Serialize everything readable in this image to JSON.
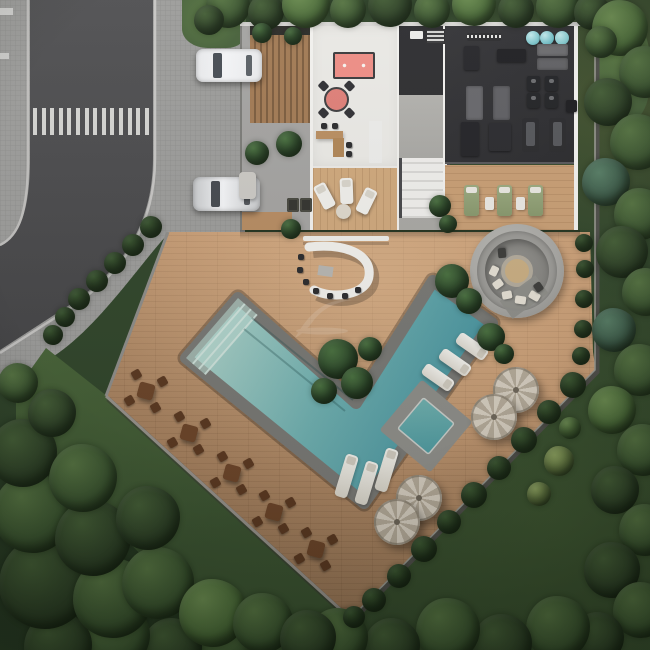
{
  "scene": {
    "kind": "aerial-site-plan-render",
    "view": "top-down",
    "areas": [
      "street",
      "sidewalk",
      "parking-bay",
      "clubhouse",
      "games-room",
      "gym",
      "pergola-deck",
      "bar-counter",
      "fire-pit-lounge",
      "swimming-pool",
      "spa",
      "pool-deck",
      "dining-terrace",
      "forest"
    ]
  },
  "palette": {
    "road": "#4b4b4d",
    "sidewalk": "#9c9c9a",
    "crosswalk": "#e0e0dc",
    "deck_wood": "#c69a72",
    "terrace_wood": "#cfa87c",
    "building_floor": "#eae9e5",
    "gym_floor": "#303033",
    "pergola_wood": "#a27a54",
    "pool_shallow": "#a9cfc6",
    "pool_deep": "#3e8d9b",
    "pool_coping": "#787874",
    "billiard_felt": "#ee8d85",
    "card_table": "#df7f78",
    "bar_counter": "#f2f1ed",
    "fire_pit_concrete": "#a8a7a3",
    "umbrella": "#d6cec0",
    "dining_table": "#6b4428",
    "green_lounger": "#93a37b",
    "exercise_ball": "#7ac3c9",
    "tree_dark": "#2d4026",
    "tree_light": "#6b8c50",
    "grass": "#4c6839"
  },
  "street": {
    "crosswalk": {
      "x": 33,
      "y": 108,
      "count": 14,
      "w": 4,
      "h": 27,
      "step": 8.6
    },
    "edge_marks": [
      {
        "x": 0,
        "y": 8,
        "w": 13,
        "h": 7
      },
      {
        "x": 0,
        "y": 53,
        "w": 9,
        "h": 6
      }
    ]
  },
  "tree_palettes": {
    "d": [
      "#2d4026",
      "#445e36"
    ],
    "m": [
      "#3b5530",
      "#567442"
    ],
    "l": [
      "#4a6a38",
      "#6b8c50"
    ],
    "y": [
      "#697f45",
      "#8ba05e"
    ],
    "t": [
      "#3c5a48",
      "#567c64"
    ],
    "s": [
      "#283c22",
      "#3a5630"
    ],
    "p": [
      "#2e4a2b",
      "#49703f"
    ]
  },
  "trees": [
    [
      228,
      6,
      22,
      "m"
    ],
    [
      266,
      12,
      18,
      "d"
    ],
    [
      306,
      4,
      24,
      "l"
    ],
    [
      348,
      10,
      18,
      "m"
    ],
    [
      390,
      5,
      22,
      "d"
    ],
    [
      432,
      10,
      18,
      "m"
    ],
    [
      474,
      4,
      22,
      "l"
    ],
    [
      516,
      10,
      18,
      "d"
    ],
    [
      558,
      6,
      22,
      "m"
    ],
    [
      592,
      12,
      18,
      "d"
    ],
    [
      620,
      28,
      28,
      "l"
    ],
    [
      645,
      72,
      26,
      "m"
    ],
    [
      608,
      102,
      24,
      "d"
    ],
    [
      638,
      142,
      28,
      "m"
    ],
    [
      606,
      182,
      24,
      "t"
    ],
    [
      640,
      214,
      26,
      "m"
    ],
    [
      622,
      252,
      26,
      "d"
    ],
    [
      646,
      292,
      24,
      "m"
    ],
    [
      614,
      330,
      22,
      "t"
    ],
    [
      640,
      370,
      26,
      "m"
    ],
    [
      612,
      410,
      24,
      "l"
    ],
    [
      643,
      450,
      26,
      "m"
    ],
    [
      615,
      490,
      24,
      "d"
    ],
    [
      645,
      530,
      26,
      "m"
    ],
    [
      612,
      570,
      28,
      "d"
    ],
    [
      641,
      610,
      28,
      "m"
    ],
    [
      598,
      638,
      26,
      "d"
    ],
    [
      558,
      628,
      32,
      "m"
    ],
    [
      502,
      644,
      30,
      "d"
    ],
    [
      448,
      630,
      32,
      "m"
    ],
    [
      392,
      646,
      28,
      "d"
    ],
    [
      338,
      638,
      30,
      "m"
    ],
    [
      282,
      648,
      28,
      "d"
    ],
    [
      228,
      638,
      32,
      "m"
    ],
    [
      172,
      648,
      30,
      "d"
    ],
    [
      116,
      636,
      34,
      "m"
    ],
    [
      58,
      646,
      34,
      "d"
    ],
    [
      45,
      583,
      46,
      "d"
    ],
    [
      113,
      598,
      40,
      "m"
    ],
    [
      33,
      513,
      40,
      "m"
    ],
    [
      93,
      538,
      38,
      "d"
    ],
    [
      158,
      583,
      36,
      "m"
    ],
    [
      23,
      453,
      34,
      "d"
    ],
    [
      83,
      478,
      34,
      "m"
    ],
    [
      148,
      518,
      32,
      "d"
    ],
    [
      213,
      613,
      34,
      "l"
    ],
    [
      263,
      623,
      30,
      "m"
    ],
    [
      308,
      638,
      28,
      "d"
    ],
    [
      52,
      413,
      24,
      "d"
    ],
    [
      18,
      383,
      20,
      "m"
    ],
    [
      573,
      385,
      13,
      "s"
    ],
    [
      549,
      412,
      12,
      "s"
    ],
    [
      524,
      440,
      13,
      "s"
    ],
    [
      499,
      468,
      12,
      "s"
    ],
    [
      474,
      495,
      13,
      "s"
    ],
    [
      449,
      522,
      12,
      "s"
    ],
    [
      424,
      549,
      13,
      "s"
    ],
    [
      399,
      576,
      12,
      "s"
    ],
    [
      374,
      600,
      12,
      "s"
    ],
    [
      354,
      617,
      11,
      "s"
    ],
    [
      584,
      243,
      9,
      "s"
    ],
    [
      585,
      269,
      9,
      "s"
    ],
    [
      584,
      299,
      9,
      "s"
    ],
    [
      583,
      329,
      9,
      "s"
    ],
    [
      581,
      356,
      9,
      "s"
    ],
    [
      559,
      461,
      15,
      "y"
    ],
    [
      539,
      494,
      12,
      "y"
    ],
    [
      570,
      428,
      11,
      "l"
    ],
    [
      151,
      227,
      11,
      "s"
    ],
    [
      133,
      245,
      11,
      "s"
    ],
    [
      115,
      263,
      11,
      "s"
    ],
    [
      97,
      281,
      11,
      "s"
    ],
    [
      79,
      299,
      11,
      "s"
    ],
    [
      65,
      317,
      10,
      "s"
    ],
    [
      53,
      335,
      10,
      "s"
    ],
    [
      338,
      359,
      20,
      "p"
    ],
    [
      357,
      383,
      16,
      "p"
    ],
    [
      324,
      391,
      13,
      "p"
    ],
    [
      370,
      349,
      12,
      "p"
    ],
    [
      452,
      281,
      17,
      "p"
    ],
    [
      469,
      301,
      13,
      "p"
    ],
    [
      491,
      337,
      14,
      "p"
    ],
    [
      504,
      354,
      10,
      "p"
    ],
    [
      291,
      229,
      10,
      "p"
    ],
    [
      440,
      206,
      11,
      "p"
    ],
    [
      448,
      224,
      9,
      "p"
    ],
    [
      257,
      153,
      12,
      "p"
    ],
    [
      289,
      144,
      13,
      "p"
    ],
    [
      262,
      33,
      10,
      "p"
    ],
    [
      293,
      36,
      9,
      "p"
    ],
    [
      209,
      20,
      15,
      "d"
    ],
    [
      601,
      42,
      16,
      "m"
    ]
  ],
  "props": [
    {
      "cls": "car",
      "name": "parked-car",
      "x": 196,
      "y": 49,
      "w": 66,
      "h": 33,
      "c": "#e9eaec"
    },
    {
      "cls": "carwin",
      "name": "car-windshield",
      "x": 213,
      "y": 53,
      "w": 9,
      "h": 25,
      "c": "#474d54"
    },
    {
      "cls": "carwin",
      "name": "car-rear-window",
      "x": 246,
      "y": 55,
      "w": 6,
      "h": 21,
      "c": "#5a6066"
    },
    {
      "cls": "car",
      "name": "parked-car",
      "x": 193,
      "y": 177,
      "w": 67,
      "h": 34,
      "c": "#c8cacc"
    },
    {
      "cls": "carwin",
      "name": "car-windshield",
      "x": 211,
      "y": 181,
      "w": 9,
      "h": 26,
      "c": "#45494f"
    },
    {
      "cls": "carwin",
      "name": "car-rear-window",
      "x": 244,
      "y": 184,
      "w": 6,
      "h": 21,
      "c": "#53575c"
    },
    {
      "cls": "ball",
      "name": "exercise-ball",
      "x": 526,
      "y": 31,
      "w": 14,
      "h": 14,
      "c": "#7ac3c9"
    },
    {
      "cls": "ball",
      "name": "exercise-ball",
      "x": 540,
      "y": 31,
      "w": 14,
      "h": 14,
      "c": "#6fbcc4"
    },
    {
      "cls": "ball",
      "name": "exercise-ball",
      "x": 555,
      "y": 31,
      "w": 14,
      "h": 14,
      "c": "#83c8cd"
    },
    {
      "cls": "rackrow",
      "name": "dumbbell-rack",
      "x": 467,
      "y": 33,
      "w": 34,
      "h": 8
    },
    {
      "cls": "vbox",
      "name": "roof-vent",
      "x": 410,
      "y": 31,
      "w": 13,
      "h": 8
    },
    {
      "cls": "grille",
      "name": "roof-grille",
      "x": 426,
      "y": 29,
      "w": 17,
      "h": 13
    },
    {
      "cls": "mat",
      "name": "gym-mat",
      "x": 537,
      "y": 44,
      "w": 31,
      "h": 12,
      "c": "#6b6b6e"
    },
    {
      "cls": "mat",
      "name": "gym-mat",
      "x": 537,
      "y": 58,
      "w": 31,
      "h": 12,
      "c": "#606063"
    },
    {
      "cls": "gear",
      "name": "gym-bench",
      "x": 497,
      "y": 49,
      "w": 29,
      "h": 13,
      "c": "#1f1f22"
    },
    {
      "cls": "gear",
      "name": "weight-station",
      "x": 464,
      "y": 46,
      "w": 15,
      "h": 24,
      "c": "#26262a"
    },
    {
      "cls": "bike",
      "name": "spin-bike",
      "x": 527,
      "y": 76,
      "w": 13,
      "h": 15
    },
    {
      "cls": "bike",
      "name": "spin-bike",
      "x": 545,
      "y": 76,
      "w": 13,
      "h": 15
    },
    {
      "cls": "bike",
      "name": "spin-bike",
      "x": 527,
      "y": 93,
      "w": 13,
      "h": 15
    },
    {
      "cls": "bike",
      "name": "spin-bike",
      "x": 545,
      "y": 93,
      "w": 13,
      "h": 15
    },
    {
      "cls": "mat",
      "name": "stretch-mat",
      "x": 466,
      "y": 86,
      "w": 17,
      "h": 34,
      "c": "#67676b"
    },
    {
      "cls": "mat",
      "name": "stretch-mat",
      "x": 493,
      "y": 86,
      "w": 17,
      "h": 34,
      "c": "#5f5f63"
    },
    {
      "cls": "tread",
      "name": "treadmill",
      "x": 522,
      "y": 118,
      "w": 17,
      "h": 34
    },
    {
      "cls": "tread",
      "name": "treadmill",
      "x": 549,
      "y": 118,
      "w": 17,
      "h": 34
    },
    {
      "cls": "gear",
      "name": "gym-machine",
      "x": 461,
      "y": 122,
      "w": 18,
      "h": 34,
      "c": "#232327"
    },
    {
      "cls": "gear",
      "name": "multi-gym",
      "x": 489,
      "y": 123,
      "w": 22,
      "h": 28,
      "c": "#2a2a2e"
    },
    {
      "cls": "gear",
      "name": "gym-door",
      "x": 566,
      "y": 100,
      "w": 11,
      "h": 12,
      "c": "#1c1c1f"
    },
    {
      "cls": "stool",
      "name": "bar-stool",
      "x": 298,
      "y": 254,
      "w": 6,
      "h": 6
    },
    {
      "cls": "stool",
      "name": "bar-stool",
      "x": 297,
      "y": 267,
      "w": 6,
      "h": 6
    },
    {
      "cls": "stool",
      "name": "bar-stool",
      "x": 303,
      "y": 279,
      "w": 6,
      "h": 6
    },
    {
      "cls": "stool",
      "name": "bar-stool",
      "x": 313,
      "y": 288,
      "w": 6,
      "h": 6
    },
    {
      "cls": "stool",
      "name": "bar-stool",
      "x": 327,
      "y": 293,
      "w": 6,
      "h": 6
    },
    {
      "cls": "stool",
      "name": "bar-stool",
      "x": 342,
      "y": 293,
      "w": 6,
      "h": 6
    },
    {
      "cls": "stool",
      "name": "bar-stool",
      "x": 355,
      "y": 287,
      "w": 6,
      "h": 6
    },
    {
      "cls": "stool",
      "name": "bar-stool",
      "x": 321,
      "y": 123,
      "w": 6,
      "h": 6
    },
    {
      "cls": "stool",
      "name": "bar-stool",
      "x": 332,
      "y": 123,
      "w": 6,
      "h": 6
    },
    {
      "cls": "stool",
      "name": "bar-stool",
      "x": 346,
      "y": 142,
      "w": 6,
      "h": 6
    },
    {
      "cls": "stool",
      "name": "bar-stool",
      "x": 346,
      "y": 151,
      "w": 6,
      "h": 6
    },
    {
      "cls": "vbox",
      "name": "kitchen-counter",
      "x": 369,
      "y": 121,
      "w": 13,
      "h": 42
    },
    {
      "cls": "planter",
      "name": "planter-box",
      "x": 287,
      "y": 198,
      "w": 12,
      "h": 14
    },
    {
      "cls": "planter",
      "name": "planter-box",
      "x": 300,
      "y": 198,
      "w": 12,
      "h": 14
    },
    {
      "cls": "gbench",
      "name": "garden-bench",
      "x": 239,
      "y": 172,
      "w": 17,
      "h": 27
    },
    {
      "cls": "wlounger",
      "name": "terrace-lounger",
      "x": 318,
      "y": 183,
      "w": 13,
      "h": 26,
      "rot": -28
    },
    {
      "cls": "wlounger",
      "name": "terrace-lounger",
      "x": 340,
      "y": 178,
      "w": 13,
      "h": 26,
      "rot": -2
    },
    {
      "cls": "wlounger",
      "name": "terrace-lounger",
      "x": 360,
      "y": 188,
      "w": 13,
      "h": 26,
      "rot": 26
    },
    {
      "cls": "rtable",
      "name": "terrace-side-table",
      "x": 336,
      "y": 204,
      "w": 15,
      "h": 15
    },
    {
      "cls": "glounger",
      "name": "sun-lounger-green",
      "x": 464,
      "y": 185,
      "w": 15,
      "h": 31
    },
    {
      "cls": "glounger",
      "name": "sun-lounger-green",
      "x": 497,
      "y": 185,
      "w": 15,
      "h": 31
    },
    {
      "cls": "glounger",
      "name": "sun-lounger-green",
      "x": 528,
      "y": 185,
      "w": 15,
      "h": 31
    },
    {
      "cls": "wtable",
      "name": "side-table",
      "x": 485,
      "y": 197,
      "w": 9,
      "h": 13
    },
    {
      "cls": "wtable",
      "name": "side-table",
      "x": 516,
      "y": 197,
      "w": 9,
      "h": 13
    },
    {
      "cls": "padgray",
      "name": "concrete-pad",
      "x": 502,
      "y": 286,
      "w": 44,
      "h": 22,
      "rot": -36
    },
    {
      "cls": "plounger-d",
      "name": "pool-lounger",
      "x": 421,
      "y": 371,
      "w": 34,
      "h": 13,
      "rot": 35
    },
    {
      "cls": "plounger-d",
      "name": "pool-lounger",
      "x": 438,
      "y": 356,
      "w": 34,
      "h": 13,
      "rot": 35
    },
    {
      "cls": "plounger-d",
      "name": "pool-lounger",
      "x": 455,
      "y": 340,
      "w": 34,
      "h": 13,
      "rot": 35
    },
    {
      "cls": "plounger-b",
      "name": "wet-deck-lounger",
      "x": 340,
      "y": 454,
      "w": 13,
      "h": 44,
      "rot": 17
    },
    {
      "cls": "plounger-b",
      "name": "wet-deck-lounger",
      "x": 360,
      "y": 461,
      "w": 13,
      "h": 44,
      "rot": 17
    },
    {
      "cls": "plounger-b",
      "name": "wet-deck-lounger",
      "x": 380,
      "y": 448,
      "w": 13,
      "h": 44,
      "rot": 17
    },
    {
      "cls": "cushion",
      "name": "fire-pit-cushion",
      "x": 489,
      "y": 267,
      "w": 10,
      "h": 8,
      "rot": -65,
      "c": "#e5e0d4"
    },
    {
      "cls": "cushion",
      "name": "fire-pit-cushion",
      "x": 493,
      "y": 280,
      "w": 10,
      "h": 8,
      "rot": -35,
      "c": "#e5e0d4"
    },
    {
      "cls": "cushion",
      "name": "fire-pit-cushion",
      "x": 502,
      "y": 291,
      "w": 10,
      "h": 8,
      "rot": -10,
      "c": "#e5e0d4"
    },
    {
      "cls": "cushion",
      "name": "fire-pit-cushion",
      "x": 515,
      "y": 296,
      "w": 11,
      "h": 8,
      "rot": 8,
      "c": "#e5e0d4"
    },
    {
      "cls": "cushion",
      "name": "fire-pit-cushion",
      "x": 529,
      "y": 292,
      "w": 11,
      "h": 8,
      "rot": 30,
      "c": "#e5e0d4"
    },
    {
      "cls": "cushion",
      "name": "fire-pit-cushion",
      "x": 497,
      "y": 249,
      "w": 10,
      "h": 8,
      "rot": -95,
      "c": "#3c3c3a"
    },
    {
      "cls": "cushion",
      "name": "fire-pit-cushion",
      "x": 534,
      "y": 283,
      "w": 9,
      "h": 8,
      "rot": 55,
      "c": "#3c3c3a"
    },
    {
      "cls": "umbrella",
      "name": "patio-umbrella",
      "x": 493,
      "y": 367,
      "w": 46,
      "h": 46
    },
    {
      "cls": "umbrella",
      "name": "patio-umbrella",
      "x": 471,
      "y": 394,
      "w": 46,
      "h": 46
    },
    {
      "cls": "umbrella",
      "name": "patio-umbrella",
      "x": 396,
      "y": 475,
      "w": 46,
      "h": 46
    },
    {
      "cls": "umbrella",
      "name": "patio-umbrella",
      "x": 374,
      "y": 499,
      "w": 46,
      "h": 46
    },
    {
      "cls": "dtable",
      "name": "dining-table-set",
      "x": 127,
      "y": 372,
      "w": 38,
      "h": 38,
      "rot": 15
    },
    {
      "cls": "dtable",
      "name": "dining-table-set",
      "x": 170,
      "y": 414,
      "w": 38,
      "h": 38,
      "rot": 15
    },
    {
      "cls": "dtable",
      "name": "dining-table-set",
      "x": 213,
      "y": 454,
      "w": 38,
      "h": 38,
      "rot": 15
    },
    {
      "cls": "dtable",
      "name": "dining-table-set",
      "x": 255,
      "y": 493,
      "w": 38,
      "h": 38,
      "rot": 15
    },
    {
      "cls": "dtable",
      "name": "dining-table-set",
      "x": 297,
      "y": 530,
      "w": 38,
      "h": 38,
      "rot": 15
    }
  ]
}
